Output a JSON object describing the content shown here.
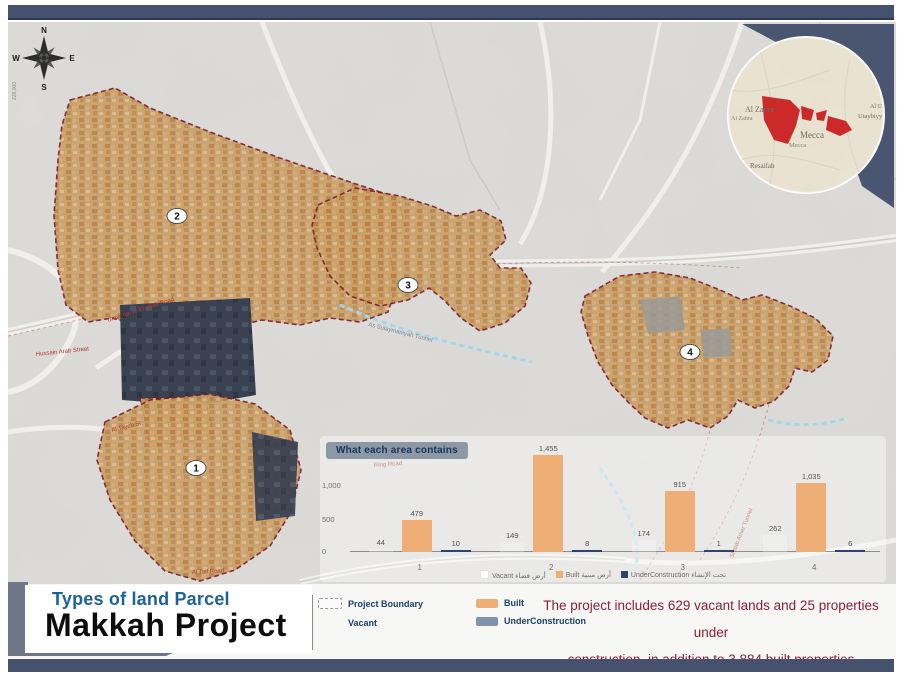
{
  "frame": {
    "bar_color": "#46526d"
  },
  "compass": {
    "north": "N",
    "east": "E",
    "south": "S",
    "west": "W"
  },
  "map": {
    "grid_label": "228,000",
    "markers": [
      {
        "label": "1"
      },
      {
        "label": "2"
      },
      {
        "label": "3"
      },
      {
        "label": "4"
      }
    ],
    "road_labels": [
      "Hussain Arab Street",
      "Umar Ibn Al Khattab Road",
      "Al Tayeb St",
      "Ring Road",
      "Al Taif Road",
      "Shaab Amer Tunnel"
    ],
    "tunnel_label": "As Sulaymaniyah Tunnel",
    "boundary_color": "#7d1f2d",
    "built_color": "#c9a169",
    "underconstruction_color": "#3a4150"
  },
  "inset": {
    "labels": {
      "al_zahra_big": "Al Zahra",
      "al_zahra_small": "Al Zahra",
      "mecca_big": "Mecca",
      "mecca_small": "Mecca",
      "resaifah": "Resaifah",
      "al_u": "Al U",
      "utaybiyy": "Utaybiyy"
    },
    "highlight_color": "#cc2a2a"
  },
  "chart_data": {
    "type": "bar",
    "title": "What each area contains",
    "categories": [
      "1",
      "2",
      "3",
      "4"
    ],
    "series": [
      {
        "name": "Vacant",
        "name_ar": "أرض فضاء",
        "color": "rgba(255,255,255,0.25)",
        "values": [
          44,
          149,
          174,
          262
        ],
        "labels": [
          "44",
          "149",
          "174",
          "262"
        ]
      },
      {
        "name": "Built",
        "name_ar": "أرض مبنية",
        "color": "#f0ae77",
        "values": [
          479,
          1455,
          915,
          1035
        ],
        "labels": [
          "479",
          "1,455",
          "915",
          "1,035"
        ]
      },
      {
        "name": "UnderConstruction",
        "name_ar": "تحت الإنشاء",
        "color": "#2e4470",
        "values": [
          10,
          8,
          1,
          6
        ],
        "labels": [
          "10",
          "8",
          "1",
          "6"
        ]
      }
    ],
    "y_ticks": [
      "0",
      "500",
      "1,000"
    ],
    "ylim": [
      0,
      1500
    ],
    "grid": false,
    "legend_position": "bottom"
  },
  "legend": {
    "project_boundary": "Project Boundary",
    "vacant": "Vacant",
    "built": "Built",
    "underconstruction": "UnderConstruction"
  },
  "title_block": {
    "subtitle": "Types of land Parcel",
    "title": "Makkah Project"
  },
  "summary_line1": "The project includes 629 vacant lands and 25 properties under",
  "summary_line2": "construction, in addition to 3,884 built properties"
}
